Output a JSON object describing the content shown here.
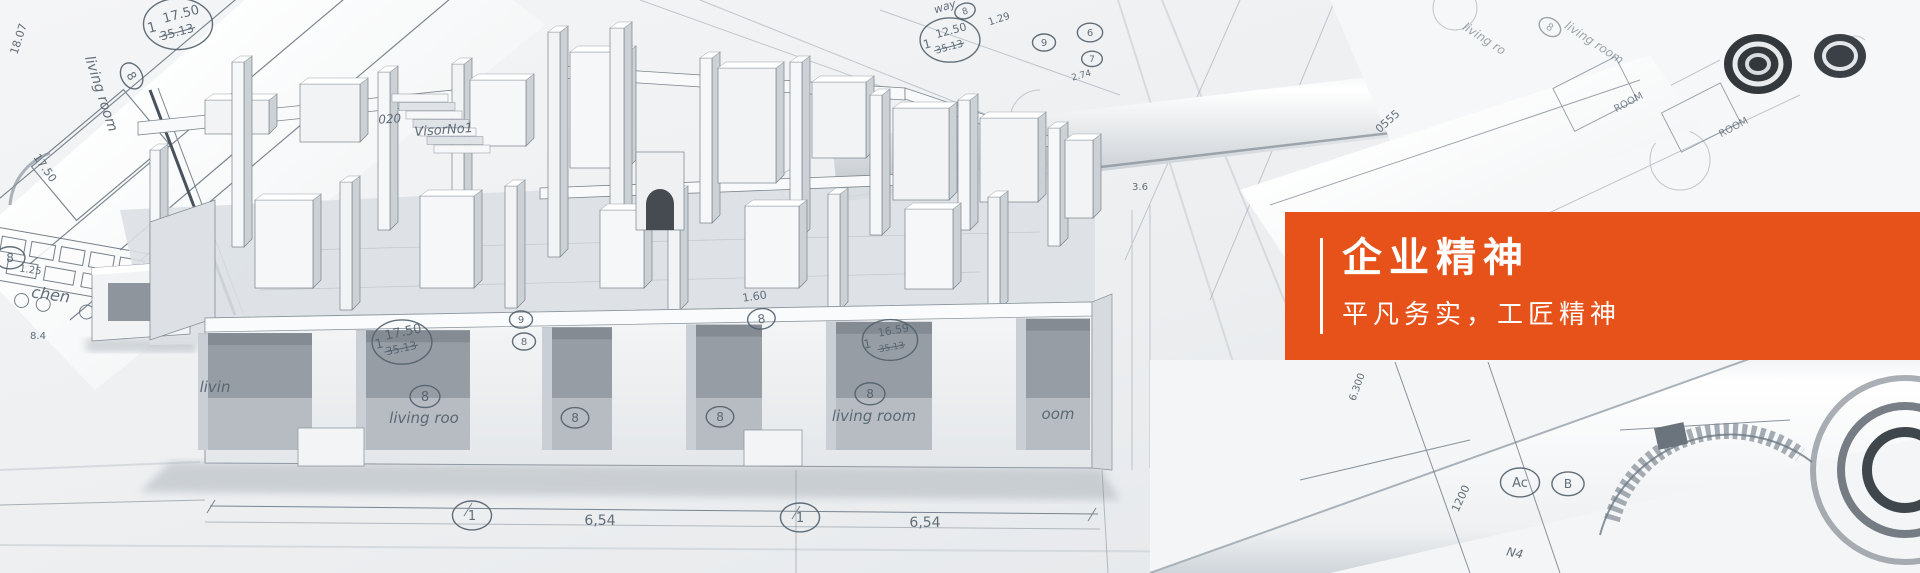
{
  "banner": {
    "title": "企业精神",
    "subtitle": "平凡务实，工匠精神"
  },
  "colors": {
    "accent": "#e6521a",
    "panel_text": "#ffffff",
    "blueprint_line": "#52606c"
  },
  "photo_labels": [
    {
      "t": "18.07",
      "x": 22,
      "y": 40,
      "s": 11,
      "r": -72
    },
    {
      "t": "17.50",
      "x": 182,
      "y": 18,
      "s": 13,
      "r": -15
    },
    {
      "t": "35.13",
      "x": 178,
      "y": 36,
      "s": 12,
      "r": -15,
      "k": true
    },
    {
      "t": "1",
      "x": 153,
      "y": 32,
      "s": 14,
      "r": -15
    },
    {
      "t": "",
      "x": 178,
      "y": 24,
      "c": 30
    },
    {
      "t": "living room",
      "x": 97,
      "y": 95,
      "s": 14,
      "r": 72,
      "i": true
    },
    {
      "t": "8",
      "x": 128,
      "y": 78,
      "s": 12,
      "r": 60,
      "c": 12
    },
    {
      "t": "17.50",
      "x": 42,
      "y": 170,
      "s": 11,
      "r": 55
    },
    {
      "t": "8",
      "x": 10,
      "y": 262,
      "s": 12,
      "c": 13
    },
    {
      "t": "1.25",
      "x": 30,
      "y": 273,
      "s": 10,
      "r": 8
    },
    {
      "t": "chen",
      "x": 50,
      "y": 300,
      "s": 16,
      "r": 8,
      "i": true
    },
    {
      "t": "8.4",
      "x": 38,
      "y": 339,
      "s": 10
    },
    {
      "t": "020",
      "x": 390,
      "y": 123,
      "s": 12,
      "r": -4,
      "i": true
    },
    {
      "t": "VisorNo1",
      "x": 444,
      "y": 134,
      "s": 13,
      "r": -4,
      "i": true
    },
    {
      "t": "way",
      "x": 946,
      "y": 10,
      "s": 11,
      "r": -18,
      "i": true
    },
    {
      "t": "8",
      "x": 966,
      "y": 14,
      "s": 9,
      "r": -18,
      "c": 9
    },
    {
      "t": "1.29",
      "x": 1000,
      "y": 22,
      "s": 10,
      "r": -18
    },
    {
      "t": "12.50",
      "x": 952,
      "y": 34,
      "s": 11,
      "r": -15
    },
    {
      "t": "35.13",
      "x": 950,
      "y": 50,
      "s": 10,
      "r": -15,
      "k": true
    },
    {
      "t": "1",
      "x": 928,
      "y": 48,
      "s": 12,
      "r": -15
    },
    {
      "t": "",
      "x": 950,
      "y": 40,
      "c": 26
    },
    {
      "t": "9",
      "x": 1044,
      "y": 46,
      "s": 10,
      "c": 10
    },
    {
      "t": "6",
      "x": 1090,
      "y": 36,
      "s": 10,
      "c": 11
    },
    {
      "t": "7",
      "x": 1092,
      "y": 62,
      "s": 9,
      "c": 9
    },
    {
      "t": "2.74",
      "x": 1082,
      "y": 78,
      "s": 9,
      "r": -15
    },
    {
      "t": "3.6",
      "x": 1140,
      "y": 190,
      "s": 10
    },
    {
      "t": "17.50",
      "x": 404,
      "y": 336,
      "s": 13,
      "r": -12
    },
    {
      "t": "35.13",
      "x": 402,
      "y": 352,
      "s": 11,
      "r": -12,
      "k": true
    },
    {
      "t": "1",
      "x": 380,
      "y": 348,
      "s": 13,
      "r": -12
    },
    {
      "t": "",
      "x": 402,
      "y": 342,
      "c": 26
    },
    {
      "t": "9",
      "x": 521,
      "y": 323,
      "s": 10,
      "c": 10
    },
    {
      "t": "8",
      "x": 524,
      "y": 345,
      "s": 10,
      "c": 10
    },
    {
      "t": "1.60",
      "x": 755,
      "y": 300,
      "s": 11,
      "r": -8
    },
    {
      "t": "8",
      "x": 762,
      "y": 323,
      "s": 12,
      "r": -8,
      "c": 12
    },
    {
      "t": "16.59",
      "x": 894,
      "y": 334,
      "s": 11,
      "r": -10
    },
    {
      "t": "35.13",
      "x": 892,
      "y": 350,
      "s": 9,
      "r": -10,
      "k": true
    },
    {
      "t": "1",
      "x": 868,
      "y": 348,
      "s": 12,
      "r": -10
    },
    {
      "t": "",
      "x": 890,
      "y": 340,
      "c": 24
    },
    {
      "t": "livin",
      "x": 215,
      "y": 392,
      "s": 15,
      "i": true
    },
    {
      "t": "8",
      "x": 425,
      "y": 401,
      "s": 13,
      "c": 13
    },
    {
      "t": "living roo",
      "x": 424,
      "y": 423,
      "s": 15,
      "i": true
    },
    {
      "t": "8",
      "x": 575,
      "y": 422,
      "s": 12,
      "c": 12
    },
    {
      "t": "8",
      "x": 720,
      "y": 421,
      "s": 12,
      "c": 12
    },
    {
      "t": "8",
      "x": 870,
      "y": 398,
      "s": 12,
      "c": 13
    },
    {
      "t": "living room",
      "x": 874,
      "y": 421,
      "s": 15,
      "i": true
    },
    {
      "t": "oom",
      "x": 1058,
      "y": 419,
      "s": 15,
      "i": true
    },
    {
      "t": "1",
      "x": 472,
      "y": 520,
      "s": 13,
      "c": 17
    },
    {
      "t": "6,54",
      "x": 600,
      "y": 525,
      "s": 14
    },
    {
      "t": "1",
      "x": 800,
      "y": 522,
      "s": 13,
      "c": 17
    },
    {
      "t": "6,54",
      "x": 925,
      "y": 527,
      "s": 14
    },
    {
      "t": "0555",
      "x": 1390,
      "y": 124,
      "s": 11,
      "r": -42
    },
    {
      "t": "living ro",
      "x": 1482,
      "y": 42,
      "s": 12,
      "r": 33,
      "i": true,
      "o": 0.55
    },
    {
      "t": "8",
      "x": 1548,
      "y": 30,
      "s": 10,
      "r": 33,
      "c": 10,
      "o": 0.55
    },
    {
      "t": "living room",
      "x": 1592,
      "y": 46,
      "s": 12,
      "r": 33,
      "i": true,
      "o": 0.55
    },
    {
      "t": "ROOM",
      "x": 1630,
      "y": 105,
      "s": 10,
      "r": -28,
      "o": 0.75
    },
    {
      "t": "ROOM",
      "x": 1735,
      "y": 130,
      "s": 10,
      "r": -28,
      "o": 0.75
    },
    {
      "t": "6.300",
      "x": 1360,
      "y": 388,
      "s": 10,
      "r": -70
    },
    {
      "t": "1200",
      "x": 1464,
      "y": 500,
      "s": 11,
      "r": -65
    },
    {
      "t": "Ac",
      "x": 1520,
      "y": 487,
      "s": 13,
      "c": 17
    },
    {
      "t": "B",
      "x": 1568,
      "y": 488,
      "s": 12,
      "c": 14
    },
    {
      "t": "N4",
      "x": 1514,
      "y": 557,
      "s": 12,
      "r": 12,
      "i": true
    }
  ]
}
